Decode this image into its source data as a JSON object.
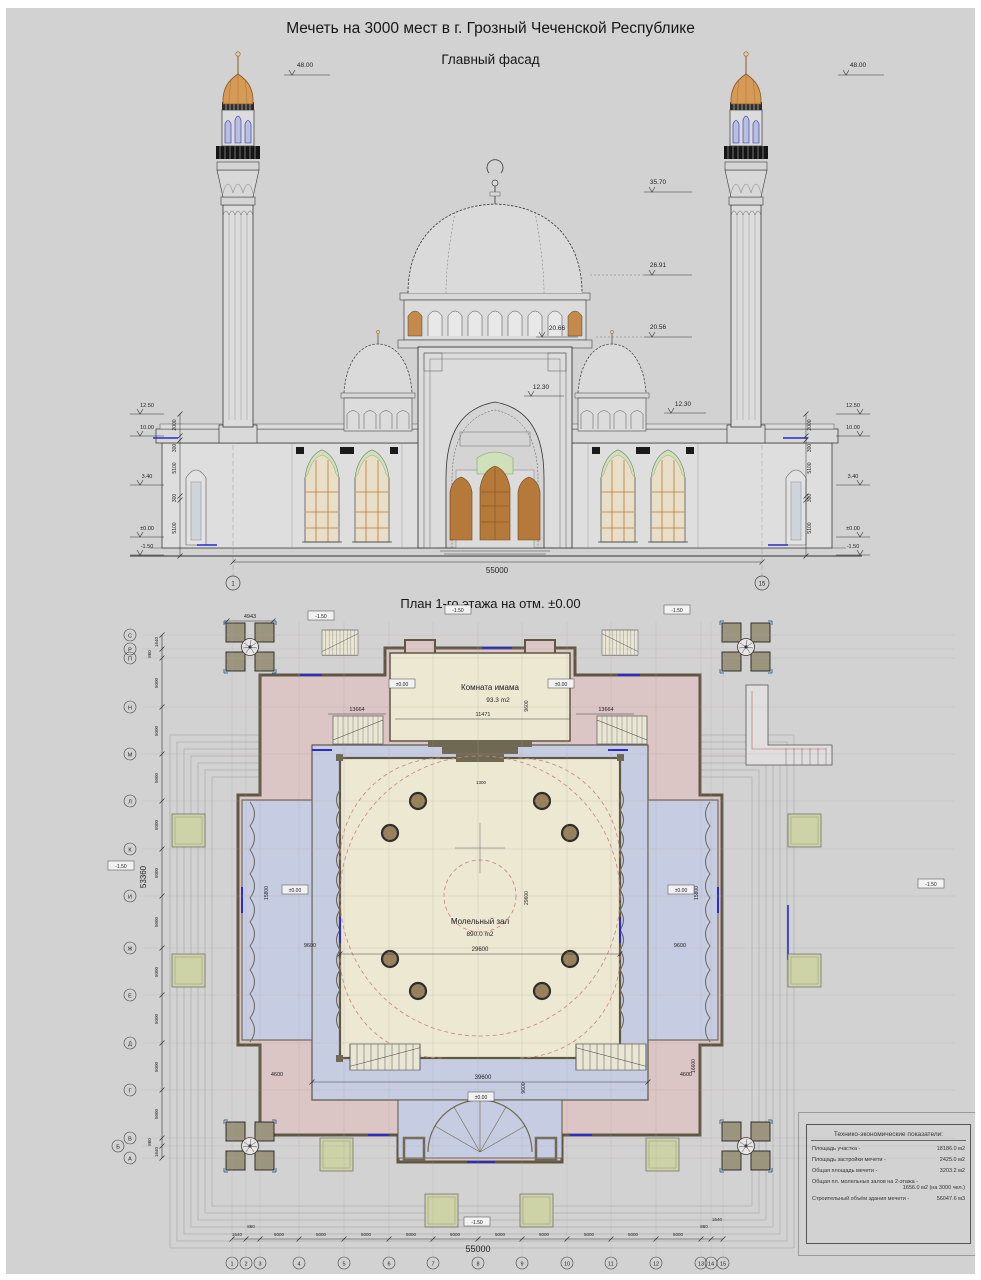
{
  "titles": {
    "main": "Мечеть на 3000 мест в г. Грозный Чеченской Республике",
    "facade": "Главный фасад",
    "plan": "План 1-го этажа на отм. ±0.00"
  },
  "facade": {
    "d48_left": "48.00",
    "d48_right": "48.00",
    "d3570": "35.70",
    "d2691": "26.91",
    "d2056": "20.56",
    "d2066": "20.66",
    "d1230_center": "12.30",
    "d1230_right": "12.30",
    "levels_left": [
      "12.50",
      "10.00",
      "3.40",
      "±0.00",
      "-1.50"
    ],
    "levels_right": [
      "12.50",
      "10.00",
      "3.40",
      "±0.00",
      "-1.50"
    ],
    "vdims": [
      "2000",
      "300",
      "5100",
      "300",
      "5100"
    ],
    "total_width": "55000",
    "axis_first": "1",
    "axis_last": "15"
  },
  "plan": {
    "room_imam_name": "Комната имама",
    "room_imam_area": "93.3 m2",
    "room_hall_name": "Молельный зал",
    "room_hall_area": "890.0 m2",
    "lvl_zero": "±0.00",
    "lvl_minus": "-1.50",
    "d4943": "4943",
    "d11471": "11471",
    "d9600": "9600",
    "d13664": "13664",
    "d29600": "29600",
    "d15800": "15800",
    "d16600": "16600",
    "d4600": "4600",
    "d39600": "39600",
    "d1300": "1300",
    "total_width": "55000",
    "total_height": "53360",
    "grid_bottom": [
      "1",
      "2",
      "3",
      "4",
      "5",
      "6",
      "7",
      "8",
      "9",
      "10",
      "11",
      "12",
      "13",
      "14",
      "15"
    ],
    "grid_left": [
      "С",
      "Р",
      "П",
      "Н",
      "М",
      "Л",
      "К",
      "И",
      "Ж",
      "Е",
      "Д",
      "Г",
      "В",
      "Б",
      "А"
    ],
    "dims_bottom": [
      "1640",
      "860",
      "5000",
      "5000",
      "5000",
      "5000",
      "5000",
      "5000",
      "5000",
      "5000",
      "5000",
      "5000",
      "860",
      "1640"
    ],
    "dims_left": [
      "1640",
      "860",
      "5000",
      "5000",
      "5000",
      "5000",
      "5000",
      "5000",
      "5000",
      "5000",
      "5000",
      "5000",
      "860",
      "1640"
    ]
  },
  "table": {
    "title": "Технико-экономические показатели:",
    "rows": [
      {
        "label": "Площадь участка -",
        "value": "18186.0 м2"
      },
      {
        "label": "Площадь застройки мечети -",
        "value": "2425.0 м2"
      },
      {
        "label": "Общая площадь мечети -",
        "value": "3203.2 м2"
      },
      {
        "label": "Общая пл. молельных залов на 2-этажа -",
        "value": "1656.0 м2 (на 3000 чел.)"
      },
      {
        "label": "Строительный объём здания мечети -",
        "value": "56047.6 м3"
      }
    ]
  }
}
